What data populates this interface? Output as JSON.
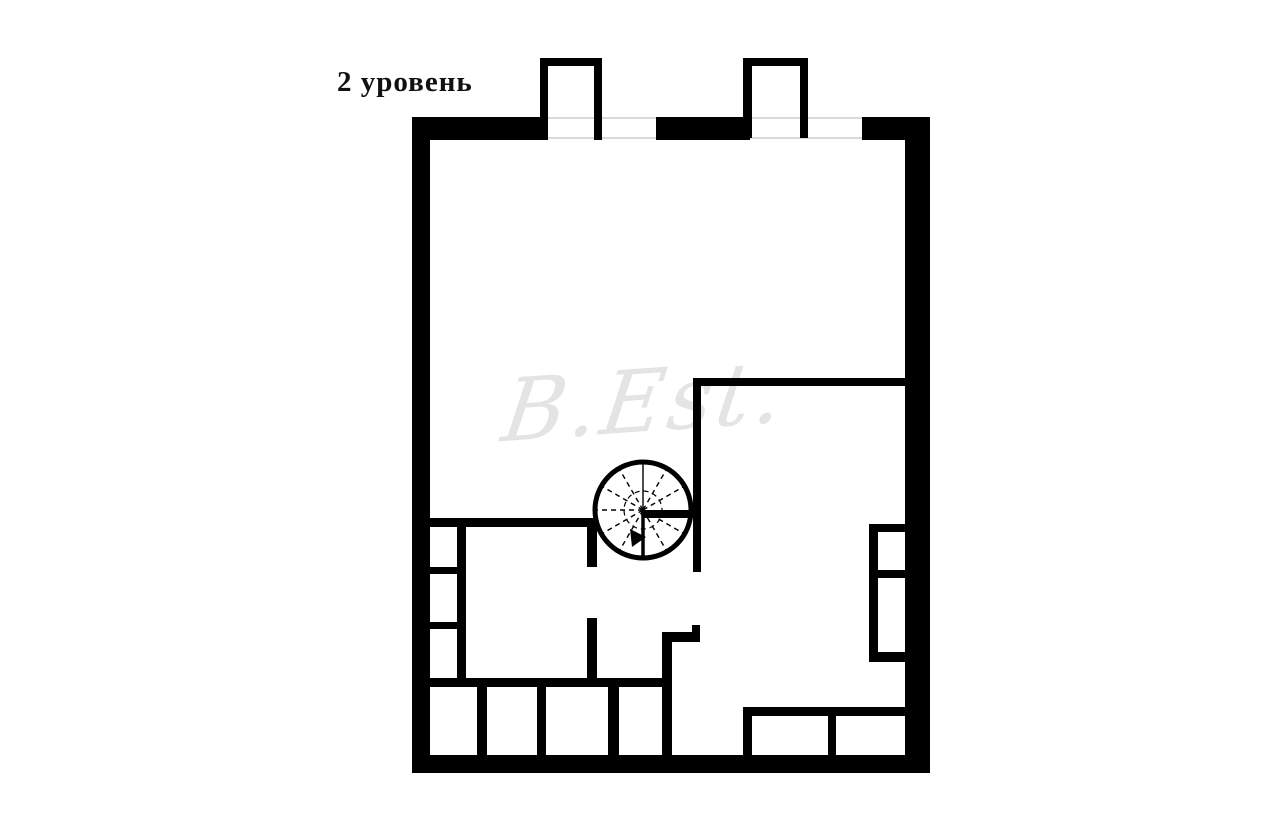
{
  "title": {
    "text": "2 уровень"
  },
  "watermark": {
    "text": "B.Est."
  },
  "colors": {
    "wall": "#000000",
    "window_line": "#d9d9d9",
    "stair_line": "#000000",
    "watermark": "#e4e4e4"
  },
  "floorplan": {
    "outer_walls": [
      [
        412,
        117,
        18,
        656
      ],
      [
        412,
        117,
        133,
        23
      ],
      [
        656,
        117,
        94,
        23
      ],
      [
        862,
        117,
        68,
        23
      ],
      [
        905,
        117,
        25,
        656
      ],
      [
        412,
        755,
        518,
        18
      ]
    ],
    "roof_projections": [
      [
        540,
        58,
        8,
        82
      ],
      [
        540,
        58,
        62,
        8
      ],
      [
        594,
        58,
        8,
        82
      ],
      [
        743,
        58,
        9,
        80
      ],
      [
        743,
        58,
        65,
        8
      ],
      [
        800,
        58,
        8,
        80
      ]
    ],
    "interior_walls": [
      [
        430,
        518,
        160,
        9
      ],
      [
        457,
        527,
        9,
        160
      ],
      [
        430,
        567,
        36,
        7
      ],
      [
        430,
        622,
        36,
        7
      ],
      [
        430,
        678,
        232,
        9
      ],
      [
        477,
        687,
        10,
        68
      ],
      [
        537,
        687,
        9,
        68
      ],
      [
        608,
        687,
        11,
        68
      ],
      [
        587,
        518,
        10,
        49
      ],
      [
        587,
        618,
        10,
        69
      ],
      [
        643,
        510,
        58,
        8
      ],
      [
        693,
        378,
        8,
        194
      ],
      [
        692,
        625,
        8,
        17
      ],
      [
        662,
        632,
        38,
        10
      ],
      [
        662,
        632,
        10,
        123
      ],
      [
        697,
        378,
        208,
        8
      ],
      [
        869,
        524,
        38,
        8
      ],
      [
        869,
        524,
        9,
        138
      ],
      [
        869,
        652,
        38,
        10
      ],
      [
        878,
        570,
        29,
        8
      ],
      [
        743,
        707,
        164,
        9
      ],
      [
        743,
        707,
        9,
        48
      ],
      [
        828,
        716,
        8,
        39
      ]
    ],
    "window_lines": [
      [
        545,
        117,
        111,
        2
      ],
      [
        545,
        137,
        111,
        2
      ],
      [
        750,
        117,
        112,
        2
      ],
      [
        750,
        137,
        112,
        2
      ]
    ],
    "stair": {
      "cx": 643,
      "cy": 510,
      "r": 48,
      "inner_r": 19,
      "solid_angles": [
        90
      ],
      "dashed_angles": [
        30,
        60,
        120,
        150,
        180,
        210,
        240,
        300,
        330
      ],
      "down_edge": [
        643,
        510,
        643,
        559
      ],
      "arrow": "630,529 646,537 632,547"
    }
  }
}
